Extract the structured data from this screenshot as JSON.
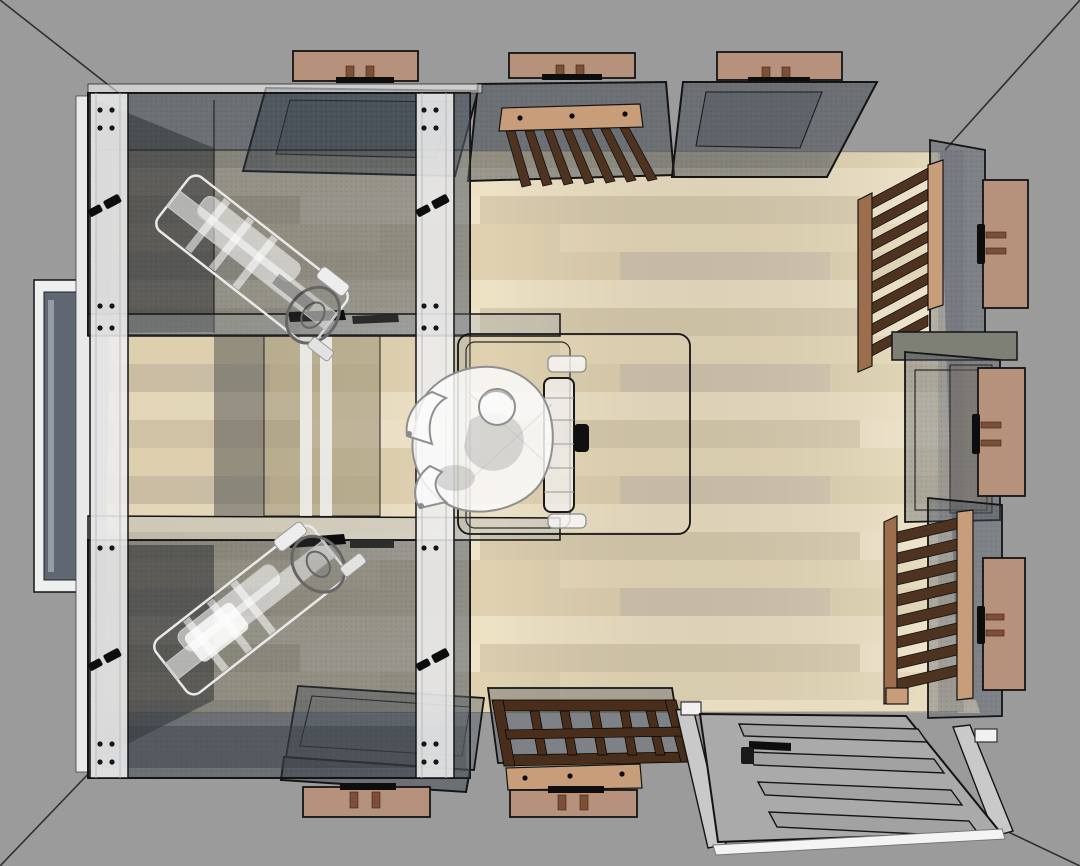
{
  "scene": {
    "label": "top-down-3d-room-render",
    "room": {
      "floor_material": "light-wood-planks",
      "wall_color_outside": "gray",
      "corner_guide_lines": 4
    },
    "left_enclosure": {
      "type": "glass-cabin",
      "glass_boxes": 2,
      "machines_inside": 2,
      "machine_style": "white-wireframe-exercise-machine",
      "mullion_handles": 4,
      "left_wall_window": 1
    },
    "center": {
      "figure": "seated-person-top-view",
      "figure_style": "translucent-white-wireframe",
      "seat_back": 1
    },
    "top_wall": {
      "window_units": 3,
      "exterior_panels": 3,
      "slatted_backrests": 1
    },
    "right_wall": {
      "slatted_backrests": 2,
      "window_units": 1,
      "exterior_panels": 3
    },
    "bottom_wall": {
      "window_units": 2,
      "exterior_panels": 2,
      "duckboard_benches": 1
    },
    "door": {
      "style": "white-four-panel",
      "panel_count": 4,
      "handle": "black-lever",
      "state": "laid-flat-in-doorway"
    }
  },
  "colors": {
    "bg": "#9b9b9b",
    "line": "#2f2f2f",
    "ink": "#141414",
    "floor_a": "#e8dab9",
    "floor_b": "#e0d2b1",
    "floor_c": "#eee2c5",
    "floor_d": "#d9ccae",
    "floor_acc1": "#d2c6ae",
    "floor_acc2": "#f0e5ca",
    "threshold": "#e9ddc1",
    "glass_dark": "rgba(52,60,72,0.45)",
    "glass_mid": "rgba(78,88,100,0.38)",
    "glass_light": "rgba(165,172,180,0.32)",
    "glass_inner": "rgba(70,76,86,0.35)",
    "interior_shadow": "rgba(40,42,46,0.50)",
    "white_frame": "rgba(238,238,238,0.88)",
    "panel_brown": "#b6927d",
    "peg_brown": "#7d5036",
    "rail_light": "#c89d79",
    "rail_mid": "#9c6e4e",
    "slat_dark": "#4f3321",
    "duck_dark": "#4a2e1c",
    "olive_slab": "#7e8076",
    "window_pane_dark": "#5f6872",
    "tint_dark": "rgba(85,88,86,0.55)",
    "tint_tan": "rgba(148,138,110,0.50)",
    "door_gray": "#aaaaaa",
    "door_panel": "#a2a2a2",
    "door_frame_strip": "#c9c9c9",
    "jamb_white": "#f1f1f1",
    "sill_white": "#f4f4f4",
    "machine_stroke": "#e9e9e9",
    "machine_fill": "rgba(255,255,255,0.55)",
    "wheel_stroke": "#666666",
    "person_fill": "rgba(250,250,250,0.85)",
    "person_stroke": "#8f8f8f",
    "person_shadow": "rgba(150,150,150,0.33)",
    "hardware_black": "#0d0d0d"
  }
}
